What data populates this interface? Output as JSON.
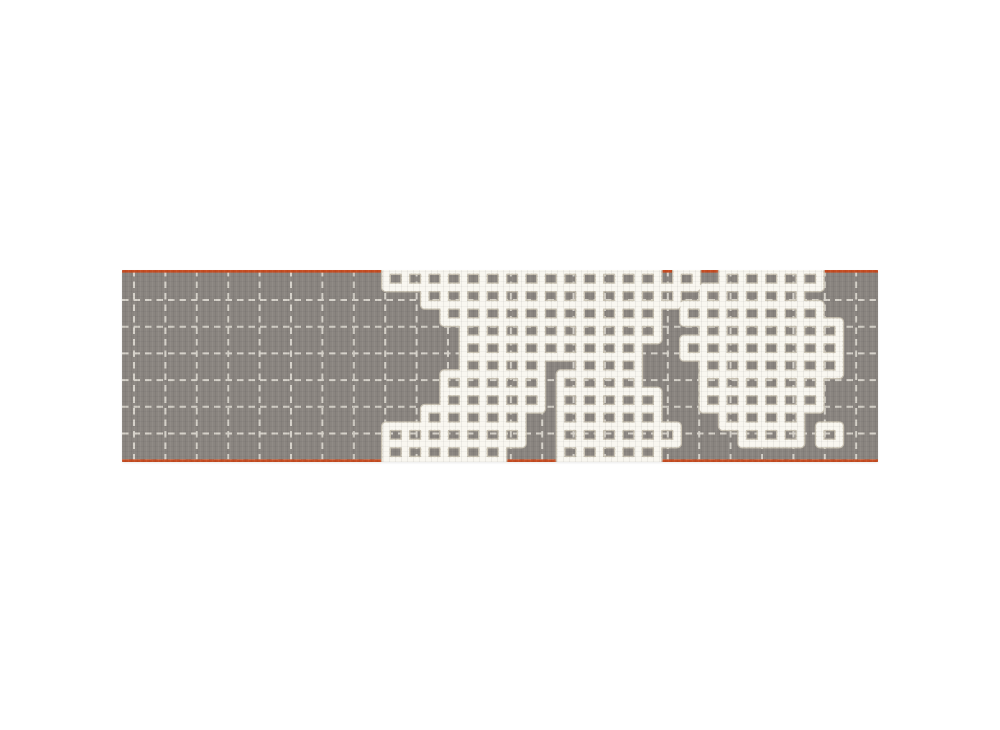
{
  "scene": {
    "description": "Product photograph of a rectangular grey wool runner rug on a plain white background. The rug has a stitched off-white dashed grid pattern, thin orange trim along the top and bottom edges, and two large irregular patches of chunky cream crochet-style grid embroidery covering the centre and right areas.",
    "background_color": "#ffffff"
  },
  "rug": {
    "x": 122,
    "y": 270,
    "width": 756,
    "height": 192,
    "base_color": "#8a8580",
    "stitch_grid": {
      "color": "#d9d5cc",
      "offset_x": 12,
      "offset_y": 30,
      "cell_w": 31.4,
      "cell_h": 26.7,
      "line_width": 2,
      "dash": "6.5 5"
    },
    "trim": {
      "color": "#c84e23",
      "thickness": 2.6,
      "edges": [
        "top",
        "bottom"
      ]
    },
    "embroidery": {
      "main_color": "#f1eee5",
      "shadow_color": "#cdc6b6",
      "bead_color": "#f9f7f0",
      "main_width": 6.5,
      "shadow_width": 10,
      "bead_width": 7.5,
      "bead_dash": "0.6 3.2",
      "cell_w": 19.4,
      "cell_h": 17.35,
      "blobs": [
        {
          "name": "main-patch",
          "origin_x": 264,
          "origin_y": 0,
          "rows": [
            "11111111111111010",
            "00111111111111100",
            "00011111111111000",
            "00001111111111000",
            "00001111111110000",
            "00001111001110000",
            "00011111011110000",
            "00011111011111000",
            "00111110011111000",
            "11111110011111100",
            "11111100011111000"
          ]
        },
        {
          "name": "right-patch",
          "origin_x": 562,
          "origin_y": 0,
          "rows": [
            "001111100",
            "011111000",
            "111111100",
            "011111110",
            "111111110",
            "011111110",
            "011111100",
            "011111100",
            "001111000",
            "000111010",
            "000000000"
          ]
        }
      ]
    }
  }
}
